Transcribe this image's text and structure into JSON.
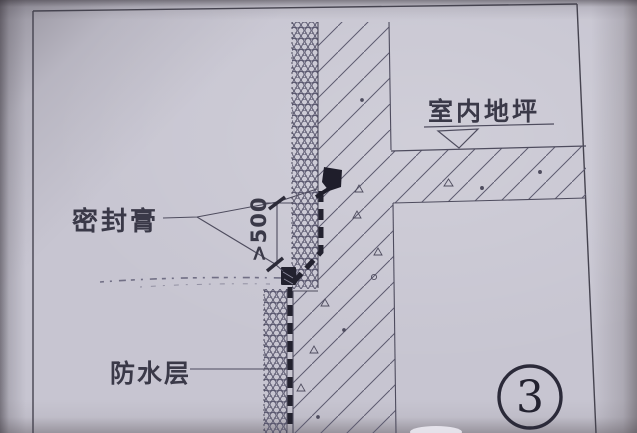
{
  "drawing": {
    "kind": "construction-detail",
    "labels": {
      "sealant": "密封膏",
      "indoor_floor_level": "室内地坪",
      "waterproof_layer": "防水层",
      "dimension": ">500",
      "detail_number": "3"
    },
    "colors": {
      "paper": "#c7c5d1",
      "ink": "#4e4c5e",
      "heavy_ink": "#23222f",
      "faint_ink": "#716f85"
    }
  }
}
